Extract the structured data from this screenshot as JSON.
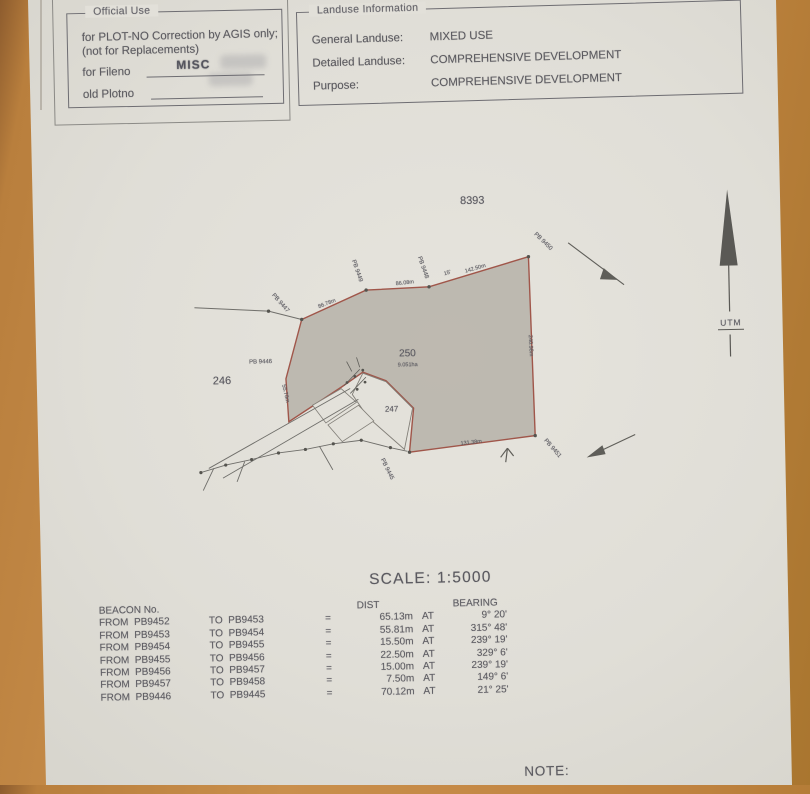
{
  "official_box": {
    "legend": "Official Use",
    "line1": "for PLOT-NO Correction by AGIS only;",
    "line2": "(not for Replacements)",
    "fileno_label": "for Fileno",
    "fileno_value": "MISC",
    "plotno_label": "old Plotno"
  },
  "landuse_box": {
    "legend": "Landuse Information",
    "general_label": "General Landuse:",
    "general_value": "MIXED USE",
    "detailed_label": "Detailed Landuse:",
    "detailed_value": "COMPREHENSIVE DEVELOPMENT",
    "purpose_label": "Purpose:",
    "purpose_value": "COMPREHENSIVE DEVELOPMENT"
  },
  "map": {
    "plot_8393": "8393",
    "plot_246": "246",
    "plot_250": "250",
    "plot_250_area": "9.051ha",
    "plot_247": "247",
    "beacons": {
      "pb9447": "PB 9447",
      "pb9449": "PB 9449",
      "pb9448": "PB 9448",
      "pb9450": "PB 9450",
      "pb9446": "PB 9446",
      "pb9451": "PB 9451",
      "pb9445": "PB 9445"
    },
    "distances": {
      "seg1": "86.78m",
      "seg2": "86.08m",
      "seg3": "15'",
      "seg4": "142.50m",
      "left_edge": "55.78m",
      "right_edge": "240.98m",
      "bottom_edge": "131.38m"
    },
    "north_label": "UTM"
  },
  "scale_text": "SCALE: 1:5000",
  "beacon_table": {
    "header_beacon": "BEACON No.",
    "header_dist": "DIST",
    "header_bearing": "BEARING",
    "rows": [
      {
        "from": "FROM  PB9452",
        "to": "TO  PB9453",
        "eq": "=",
        "dist": "65.13m",
        "at": "AT",
        "bearing": "9° 20'"
      },
      {
        "from": "FROM  PB9453",
        "to": "TO  PB9454",
        "eq": "=",
        "dist": "55.81m",
        "at": "AT",
        "bearing": "315° 48'"
      },
      {
        "from": "FROM  PB9454",
        "to": "TO  PB9455",
        "eq": "=",
        "dist": "15.50m",
        "at": "AT",
        "bearing": "239° 19'"
      },
      {
        "from": "FROM  PB9455",
        "to": "TO  PB9456",
        "eq": "=",
        "dist": "22.50m",
        "at": "AT",
        "bearing": "329° 6'"
      },
      {
        "from": "FROM  PB9456",
        "to": "TO  PB9457",
        "eq": "=",
        "dist": "15.00m",
        "at": "AT",
        "bearing": "239° 19'"
      },
      {
        "from": "FROM  PB9457",
        "to": "TO  PB9458",
        "eq": "=",
        "dist": "7.50m",
        "at": "AT",
        "bearing": "149° 6'"
      },
      {
        "from": "FROM  PB9446",
        "to": "TO  PB9445",
        "eq": "=",
        "dist": "70.12m",
        "at": "AT",
        "bearing": "21° 25'"
      }
    ]
  },
  "note_label": "NOTE:"
}
